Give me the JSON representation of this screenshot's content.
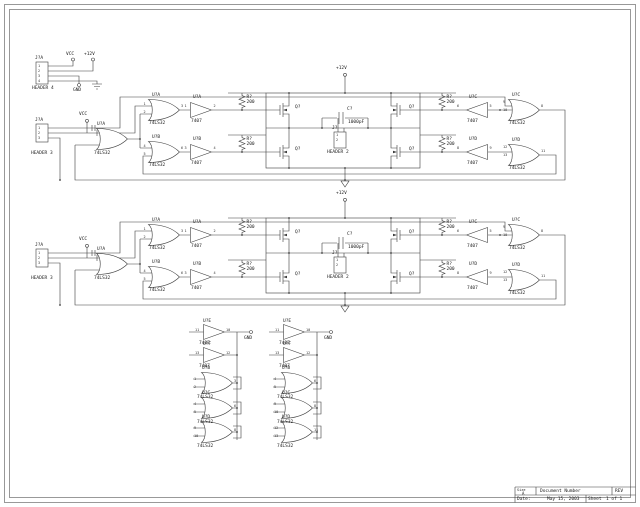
{
  "power": {
    "vcc": "VCC",
    "p12v": "+12V",
    "gnd": "GND"
  },
  "header4": {
    "ref": "J?A",
    "value": "HEADER 4",
    "pins": [
      "1",
      "2",
      "3",
      "4"
    ]
  },
  "blk": {
    "header3": {
      "ref": "J?A",
      "value": "HEADER 3",
      "pins": [
        "1",
        "2",
        "3"
      ]
    },
    "or_left": {
      "ref": "U?A",
      "value": "74LS32"
    },
    "or_top": {
      "ref": "U?A",
      "value": "74LS32",
      "pin_in1": "1",
      "pin_in2": "2",
      "pin_out": "3"
    },
    "or_bottom": {
      "ref": "U?B",
      "value": "74LS32",
      "pin_in1": "4",
      "pin_in2": "5",
      "pin_out": "6"
    },
    "buf_top": {
      "ref": "U?A",
      "value": "7407",
      "pin_in": "1",
      "pin_out": "2"
    },
    "buf_bottom": {
      "ref": "U?B",
      "value": "7407",
      "pin_in": "3",
      "pin_out": "4"
    },
    "r_top_left": {
      "ref": "R?",
      "value": "200"
    },
    "r_bottom_left": {
      "ref": "R?",
      "value": "200"
    },
    "r_top_right": {
      "ref": "R?",
      "value": "200"
    },
    "r_bottom_right": {
      "ref": "R?",
      "value": "200"
    },
    "q": {
      "ref": "Q?"
    },
    "cap": {
      "ref": "C?",
      "value": "1000pF"
    },
    "header2": {
      "ref": "J?",
      "value": "HEADER 2",
      "pins": [
        "1",
        "2"
      ]
    },
    "buf_rt": {
      "ref": "U?C",
      "value": "7407",
      "pin_in": "5",
      "pin_out": "6"
    },
    "buf_rb": {
      "ref": "U?D",
      "value": "7407",
      "pin_in": "9",
      "pin_out": "8"
    },
    "or_rt": {
      "ref": "U?C",
      "value": "74LS32",
      "pin_in1": "9",
      "pin_in2": "10",
      "pin_out": "8"
    },
    "or_rb": {
      "ref": "U?D",
      "value": "74LS32",
      "pin_in1": "12",
      "pin_in2": "13",
      "pin_out": "11"
    }
  },
  "cols": [
    {
      "gnd": "GND",
      "buffers": [
        {
          "ref": "U?E",
          "value": "7407",
          "pin_in": "11",
          "pin_out": "10"
        },
        {
          "ref": "U?F",
          "value": "7407",
          "pin_in": "13",
          "pin_out": "12"
        }
      ],
      "gates": [
        {
          "ref": "U?B",
          "value": "74LS32",
          "pin_in1": "1",
          "pin_in2": "2",
          "pin_out": "3"
        },
        {
          "ref": "U?C",
          "value": "74LS32",
          "pin_in1": "4",
          "pin_in2": "5",
          "pin_out": "6"
        },
        {
          "ref": "U?D",
          "value": "74LS32",
          "pin_in1": "9",
          "pin_in2": "10",
          "pin_out": "8"
        }
      ]
    },
    {
      "gnd": "GND",
      "buffers": [
        {
          "ref": "U?E",
          "value": "7407",
          "pin_in": "11",
          "pin_out": "10"
        },
        {
          "ref": "U?F",
          "value": "7407",
          "pin_in": "13",
          "pin_out": "12"
        }
      ],
      "gates": [
        {
          "ref": "U?B",
          "value": "74LS32",
          "pin_in1": "4",
          "pin_in2": "5",
          "pin_out": "6"
        },
        {
          "ref": "U?C",
          "value": "74LS32",
          "pin_in1": "9",
          "pin_in2": "10",
          "pin_out": "8"
        },
        {
          "ref": "U?D",
          "value": "74LS32",
          "pin_in1": "12",
          "pin_in2": "13",
          "pin_out": "11"
        }
      ]
    }
  ],
  "title_block": {
    "size_label": "Size",
    "size_value": "A",
    "doc_label": "Document Number",
    "rev_label": "REV",
    "date_label": "Date:",
    "date_value": "May 15, 2003",
    "sheet_label": "Sheet",
    "sheet_value": "1 of 1"
  }
}
